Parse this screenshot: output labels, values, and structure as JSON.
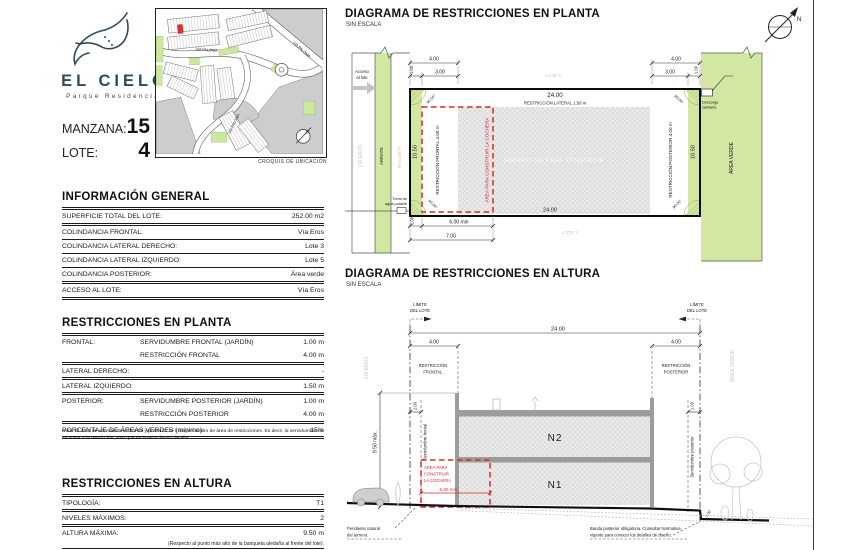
{
  "logo": {
    "brand": "EL CIELO",
    "subtitle": "Parque Residencial"
  },
  "croquis": {
    "caption": "CROQUIS DE UBICACIÓN",
    "street_label": "VÍA PALOMA"
  },
  "lot": {
    "manzana_label": "MANZANA:",
    "manzana_value": "15",
    "lote_label": "LOTE:",
    "lote_value": "4"
  },
  "info_general": {
    "title": "INFORMACIÓN GENERAL",
    "rows": [
      {
        "label": "SUPERFICIE TOTAL DEL LOTE:",
        "value": "252.00 m2"
      },
      {
        "label": "COLINDANCIA FRONTAL:",
        "value": "Vía Eros"
      },
      {
        "label": "COLINDANCIA LATERAL DERECHO:",
        "value": "Lote 3"
      },
      {
        "label": "COLINDANCIA LATERAL IZQUIERDO:",
        "value": "Lote 5"
      },
      {
        "label": "COLINDANCIA POSTERIOR:",
        "value": "Área verde"
      },
      {
        "label": "ACCESO AL LOTE:",
        "value": "Vía Eros"
      }
    ]
  },
  "planta": {
    "title": "RESTRICCIONES EN PLANTA",
    "rows": [
      {
        "label": "FRONTAL:",
        "sub": "SERVIDUMBRE FRONTAL (JARDÍN)",
        "value": "1.00 m"
      },
      {
        "label": "",
        "sub": "RESTRICCIÓN FRONTAL",
        "value": "4.00 m"
      },
      {
        "label": "LATERAL DERECHO:",
        "sub": "",
        "value": "-"
      },
      {
        "label": "LATERAL IZQUIERDO:",
        "sub": "",
        "value": "1.50 m"
      },
      {
        "label": "POSTERIOR:",
        "sub": "SERVIDUMBRE POSTERIOR (JARDÍN)",
        "value": "1.00 m"
      },
      {
        "label": "",
        "sub": "RESTRICCIÓN POSTERIOR",
        "value": "4.00 m"
      },
      {
        "label": "PORCENTAJE DE ÁREAS VERDES (mínimo):",
        "sub": "",
        "value": "15%"
      }
    ],
    "note": "Nota: El área de servidumbres frontal y posterior se incluyen dentro de área de restricciones. Es decir, la servidumbre no se suma a la restricción, sino que se inserta dentro de ella."
  },
  "altura": {
    "title": "RESTRICCIONES EN ALTURA",
    "rows": [
      {
        "label": "TIPOLOGÍA:",
        "value": "T1"
      },
      {
        "label": "NIVELES MÁXIMOS:",
        "value": "2"
      },
      {
        "label": "ALTURA MÁXIMA:",
        "value": "9.50 m"
      }
    ],
    "footnote": "(Respecto al punto más alto de la banqueta aledaña al frente del lote)."
  },
  "plan": {
    "title": "DIAGRAMA DE RESTRICCIONES EN PLANTA",
    "scale": "SIN ESCALA",
    "acceso_1": "Acceso",
    "acceso_2": "al lote",
    "via_eros": "VÍA EROS",
    "arriate": "ARRIATE",
    "banqueta": "BANQUETA",
    "lote_sup": "LOTE 5",
    "lote_inf": "LOTE 3",
    "area_verde": "ÁREA VERDE",
    "restriccion_frontal": "RESTRICCIÓN FRONTAL 4.00 m",
    "area_cochera": "ÁREA PARA CONSTRUIR LA COCHERA",
    "superficie": "SUPERFICIE PARA CONSTRUIR",
    "restriccion_lateral": "RESTRICCIÓN LATERAL 1.50 m",
    "restriccion_posterior": "RESTRICCIÓN POSTERIOR 4.00 m",
    "toma_1": "Toma de",
    "toma_2": "agua potable",
    "descarga_1": "Descarga",
    "descarga_2": "sanitaria",
    "dims": {
      "total": "24.00",
      "restr": "4.00",
      "serv": "1.00",
      "restr_net": "3.00",
      "depth": "10.50",
      "angle": "90.00°",
      "cochera_min": "6.00 min",
      "cochera_total": "7.00"
    }
  },
  "elevation": {
    "title": "DIAGRAMA DE RESTRICCIONES EN ALTURA",
    "scale": "SIN ESCALA",
    "limite_1": "LÍMITE",
    "limite_2": "DEL LOTE",
    "via_eros": "VÍA EROS",
    "area_verde": "ÁREA VERDE",
    "restr_frontal_1": "RESTRICCIÓN",
    "restr_frontal_2": "FRONTAL",
    "restr_posterior_1": "RESTRICCIÓN",
    "restr_posterior_2": "POSTERIOR",
    "serv_frontal": "Servidumbre frontal",
    "serv_posterior": "Servidumbre posterior",
    "n1": "N1",
    "n2": "N2",
    "cochera_1": "ÁREA PARA",
    "cochera_2": "CONSTRUIR",
    "cochera_3": "LA COCHERA",
    "pendiente_1": "Pendiente natural",
    "pendiente_2": "del terreno.",
    "banda_1": "Banda posterior obligatoria. Consultar Normativa",
    "banda_2": "vigente para conocer los detalles de diseño.",
    "dims": {
      "total": "24.00",
      "restr": "4.00",
      "altura": "9.50 máx.",
      "serv": "1.00",
      "cochera_min": "6.00 min.",
      "step": "1.00"
    }
  },
  "north": {
    "letter": "N"
  },
  "colors": {
    "brand_blue": "#2d4a63",
    "green": "#d2e7a2",
    "red": "#d32b2b",
    "hatch_gray": "#eaeaea"
  }
}
